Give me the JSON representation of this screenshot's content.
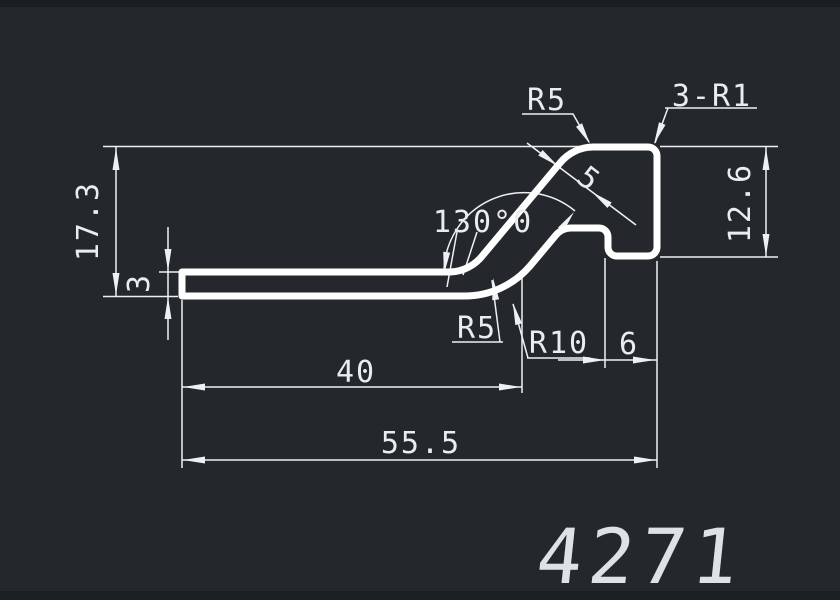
{
  "drawing": {
    "part_number": "4271",
    "type": "extrusion-profile-cross-section"
  },
  "colors": {
    "background": "#24282d",
    "line_color": "#eef1f3",
    "profile_color": "#ffffff",
    "part_number_color": "#dde2e5"
  },
  "dimensions": {
    "total_height": "17.3",
    "strip_thickness": "3",
    "flat_length": "40",
    "total_length": "55.5",
    "head_height": "12.6",
    "head_width": "6",
    "slope_thickness": "5",
    "bend_angle": "130°0",
    "fillet_head_top": "R5",
    "fillet_bend_upper": "R5",
    "fillet_bend_lower": "R10",
    "corner_fillets": "3-R1"
  }
}
